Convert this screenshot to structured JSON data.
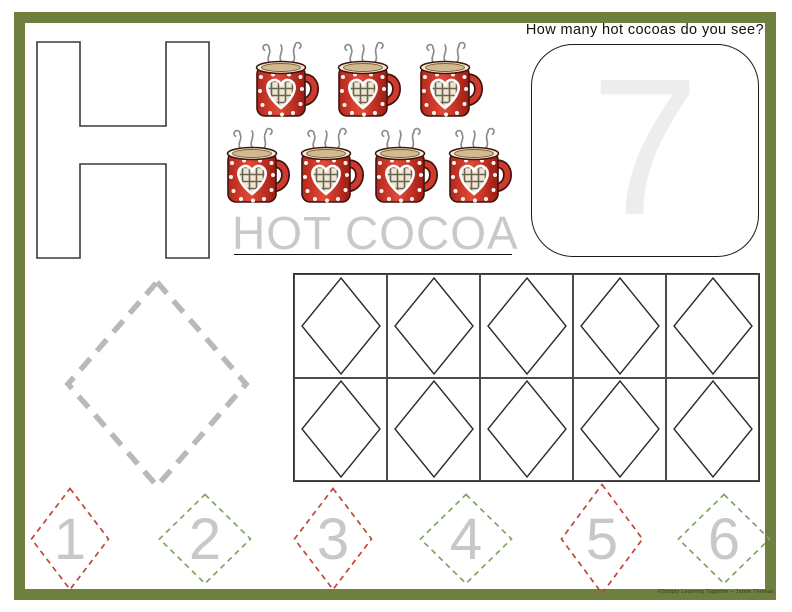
{
  "frame": {
    "border_color": "#6E7F3E"
  },
  "letter_h": {
    "letter": "H"
  },
  "question": {
    "text": "How many hot cocoas do you see?"
  },
  "answer_box": {
    "number": "7"
  },
  "word": {
    "text": "HOT COCOA"
  },
  "cocoa_mugs": {
    "count": 7,
    "rows": [
      3,
      4
    ],
    "icon": "hot-cocoa-mug-icon"
  },
  "ten_frame": {
    "rows": 2,
    "columns": 5,
    "cell_shape": "diamond"
  },
  "trace_diamond": {
    "shape": "dashed-diamond"
  },
  "practice_numbers": [
    {
      "value": "1",
      "outline": "red"
    },
    {
      "value": "2",
      "outline": "green"
    },
    {
      "value": "3",
      "outline": "red"
    },
    {
      "value": "4",
      "outline": "green"
    },
    {
      "value": "5",
      "outline": "red"
    },
    {
      "value": "6",
      "outline": "green"
    }
  ],
  "colors": {
    "border_green": "#6E7F3E",
    "dash_red": "#C2453A",
    "dash_green": "#7EA560",
    "number_gray": "#C8C8C8",
    "answer_gray": "#EDEDED",
    "word_gray": "#C9C9C9",
    "trace_gray": "#B9B9B9",
    "mug_red": "#D23A2B"
  },
  "credit": {
    "text": "©Simply Learning Together – Jamie Thomas"
  }
}
